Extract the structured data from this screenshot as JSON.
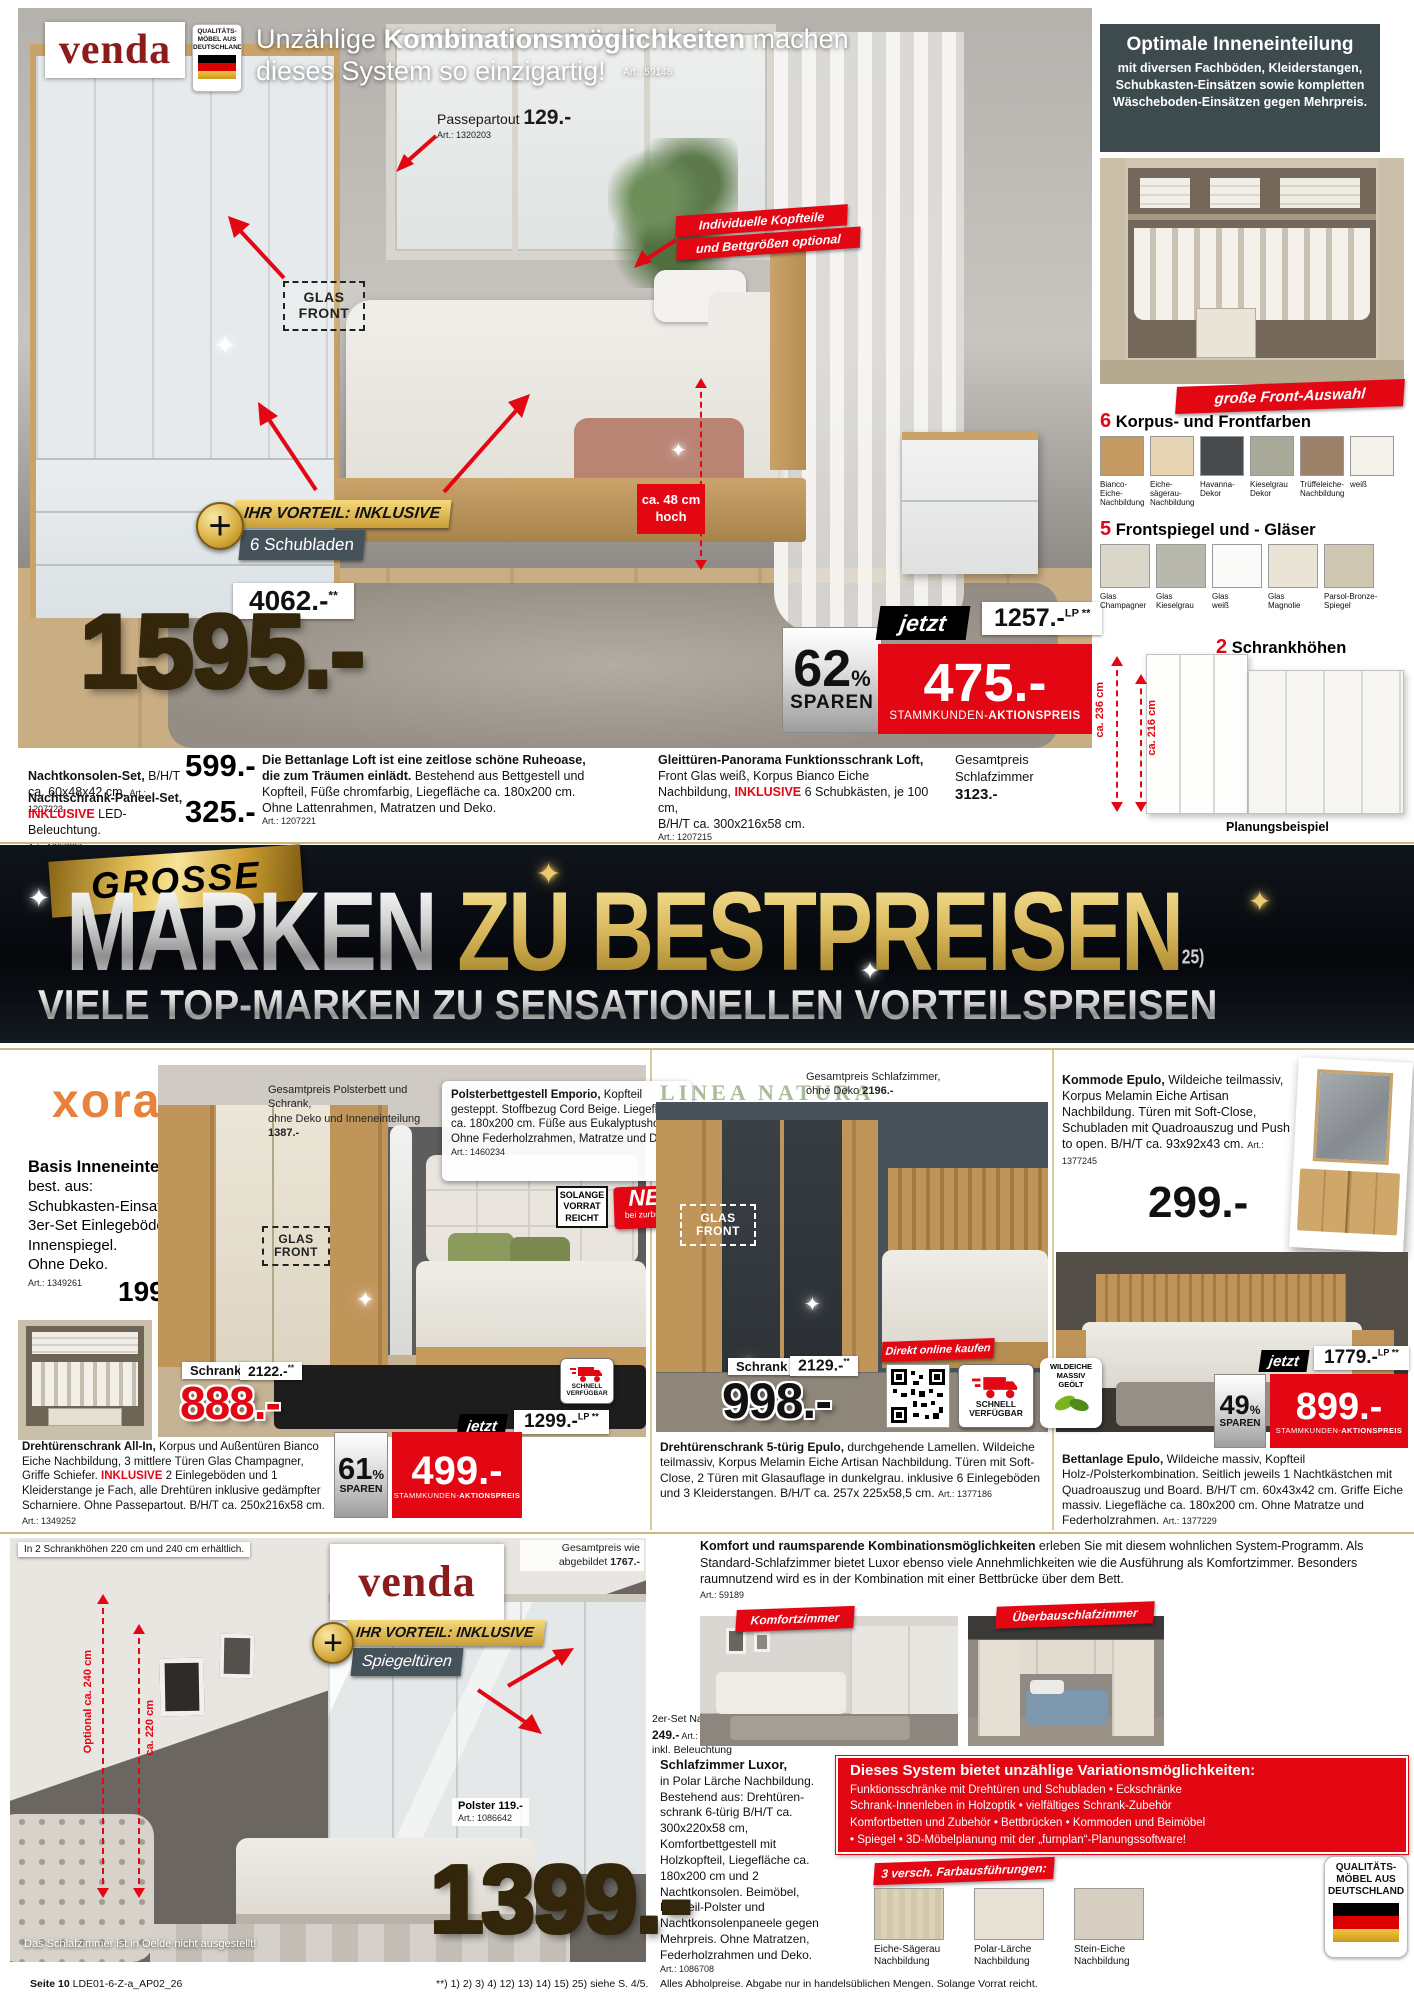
{
  "hero": {
    "logo": "venda",
    "quality": {
      "l1": "QUALITÄTS-",
      "l2": "MÖBEL AUS",
      "l3": "DEUTSCHLAND"
    },
    "headline": {
      "pre": "Unzählige ",
      "bold": "Kombinationsmöglichkeiten",
      "post": " machen",
      "line2": "dieses System so einzigartig!",
      "art": "Art.: 59148"
    },
    "passepartout": {
      "label": "Passepartout ",
      "price": "129.-",
      "art": "Art.: 1320203"
    },
    "headboard_badge": {
      "l1": "Individuelle Kopfteile",
      "l2": "und Bettgrößen optional"
    },
    "glas_front": "GLAS\nFRONT",
    "vorteil": {
      "plus": "+",
      "l1": "IHR VORTEIL: INKLUSIVE",
      "l2": "6 Schubladen"
    },
    "height_note": "ca. 48 cm\nhoch",
    "old_price": {
      "value": "4062.-",
      "sup": "**"
    },
    "big_price": "1595.-",
    "save": {
      "pct": "62",
      "sym": "%",
      "label": "SPAREN"
    },
    "jetzt": "jetzt",
    "action": {
      "price": "475.-",
      "label_normal": "STAMMKUNDEN-",
      "label_bold": "AKTIONSPREIS"
    },
    "lp": {
      "value": "1257.-",
      "sup": "LP **"
    }
  },
  "sidebar": {
    "info": {
      "title": "Optimale Inneneinteilung",
      "body": "mit diversen Fachböden, Kleiderstangen, Schubkasten-Einsätzen sowie kompletten Wäscheboden-Einsätzen gegen Mehrpreis."
    },
    "front_badge": "große Front-Auswahl",
    "colors": {
      "num": "6",
      "title": " Korpus- und Frontfarben",
      "items": [
        {
          "label": "Bianco-\nEiche-\nNachbildung",
          "hex": "#c49a62"
        },
        {
          "label": "Eiche-\nsägerau-\nNachbildung",
          "hex": "#e6d4b2"
        },
        {
          "label": "Havanna-\nDekor",
          "hex": "#474b4e"
        },
        {
          "label": "Kieselgrau\nDekor",
          "hex": "#a9a99a"
        },
        {
          "label": "Trüffeleiche-\nNachbildung",
          "hex": "#9a8168"
        },
        {
          "label": "weiß",
          "hex": "#f4f2eb"
        }
      ]
    },
    "glasses": {
      "num": "5",
      "title": " Frontspiegel und - Gläser",
      "items": [
        {
          "label": "Glas\nChampagner",
          "hex": "#dad6ca"
        },
        {
          "label": "Glas\nKieselgrau",
          "hex": "#b8b8ac"
        },
        {
          "label": "Glas\nweiß",
          "hex": "#fafaf8"
        },
        {
          "label": "Glas\nMagnolie",
          "hex": "#eae4d6"
        },
        {
          "label": "Parsol-Bronze-\nSpiegel",
          "hex": "#cfc7b2"
        }
      ]
    },
    "heights": {
      "num": "2",
      "title": " Schrankhöhen",
      "h1": "ca. 236 cm",
      "h2": "ca. 216 cm",
      "caption": "Planungsbeispiel"
    }
  },
  "strip": {
    "p1": {
      "bold": "Nachtkonsolen-Set,",
      "rest": " B/H/T\nca. 60x48x42 cm. ",
      "art": "Art.: 1207223",
      "price": "599.-"
    },
    "p2": {
      "bold": "Nachtschrank-Paneel-Set,",
      "inkl": "INKLUSIVE",
      "rest": " LED-Beleuchtung.",
      "art": "Art.: 1207227",
      "price": "325.-"
    },
    "p3": {
      "bold": "Die Bettanlage Loft ist eine zeitlose schöne Ruheoase, die zum Träumen einlädt.",
      "rest": " Bestehend aus Bettgestell und Kopfteil, Füße chromfarbig, Liegefläche ca. 180x200 cm. Ohne Lattenrahmen, Matratzen und Deko.",
      "art": "Art.: 1207221"
    },
    "p4": {
      "bold": "Gleittüren-Panorama Funktionsschrank Loft,",
      "rest": " Front Glas weiß, Korpus Bianco Eiche Nachbildung, ",
      "inkl": "INKLUSIVE",
      "rest2": " 6 Schubkästen, je 100 cm,\nB/H/T ca. 300x216x58 cm.",
      "art": "Art.: 1207215"
    },
    "total": {
      "l1": "Gesamtpreis",
      "l2": "Schlafzimmer",
      "price": "3123.-"
    }
  },
  "banner": {
    "grosse": "GROSSE",
    "marken": "MARKEN",
    "rest": " ZU BESTPREISEN",
    "sup": "25)",
    "subline": "VIELE TOP-MARKEN ZU SENSATIONELLEN VORTEILSPREISEN"
  },
  "xora": {
    "logo": "xora",
    "basis": {
      "title": "Basis Inneneinteilung",
      "body": "best. aus:\nSchubkasten-Einsatz,\n3er-Set Einlegeböden und\nInnenspiegel.\nOhne Deko.",
      "art": "Art.: 1349261",
      "price": "199.-"
    },
    "gesamt": {
      "normal": "Gesamtpreis Polsterbett und Schrank,\nohne Deko und Inneneinteilung ",
      "bold": "1387.-"
    },
    "emporio": {
      "bold": "Polsterbettgestell Emporio,",
      "rest": " Kopfteil gesteppt. Stoffbezug Cord Beige. Liegefläche ca. 180x200 cm. Füße aus Eukalyptusholz. Ohne Federholzrahmen, Matratze und Deko.",
      "art": "Art.: 1460234"
    },
    "solange": "SOLANGE\nVORRAT\nREICHT",
    "neu": {
      "big": "NEU",
      "small": "bei zurbrüggen"
    },
    "glas_front": "GLAS\nFRONT",
    "schrank_label": "Schrank",
    "old_price": {
      "value": "2122.-",
      "sup": "**"
    },
    "price": "888.-",
    "schnell": "SCHNELL\nVERFÜGBAR",
    "jetzt": "jetzt",
    "lp": {
      "value": "1299.-",
      "sup": "LP **"
    },
    "save": {
      "pct": "61",
      "sym": "%",
      "label": "SPAREN"
    },
    "action": {
      "price": "499.-",
      "label_normal": "STAMMKUNDEN-",
      "label_bold": "AKTIONSPREIS"
    },
    "desc": {
      "bold": "Drehtürenschrank All-In,",
      "rest": " Korpus und Außentüren Bianco Eiche Nachbildung, 3 mittlere Türen Glas Champagner, Griffe Schiefer. ",
      "inkl": "INKLUSIVE",
      "rest2": " 2 Einlegeböden und 1 Kleiderstange je Fach, alle Drehtüren inklusive gedämpfter Scharniere. Ohne Passepartout. B/H/T ca. 250x216x58 cm. ",
      "art": "Art.: 1349252"
    }
  },
  "linea": {
    "logo": "LINEA NATURA",
    "gesamt": {
      "normal": "Gesamtpreis Schlafzimmer,\nohne Deko ",
      "bold": "2196.-"
    },
    "glas_front": "GLAS\nFRONT",
    "schrank_label": "Schrank",
    "old_price": {
      "value": "2129.-",
      "sup": "**"
    },
    "price": "998.-",
    "direkt": "Direkt online kaufen",
    "schnell": "SCHNELL\nVERFÜGBAR",
    "wildeiche": "WILDEICHE\nMASSIV\nGEÖLT",
    "desc": {
      "bold": "Drehtürenschrank 5-türig Epulo,",
      "rest": " durchgehende Lamellen. Wildeiche teilmassiv, Korpus Melamin Eiche Artisan Nachbildung. Türen mit Soft-Close, 2 Türen mit Glasauflage in dunkelgrau. inklusive 6 Einlegeböden und 3 Kleiderstangen. B/H/T ca. 257x 225x58,5 cm. ",
      "art": "Art.: 1377186"
    }
  },
  "epulo": {
    "kommode": {
      "bold": "Kommode Epulo,",
      "rest": " Wildeiche teilmassiv, Korpus Melamin Eiche Artisan Nachbildung. Türen mit Soft-Close, Schubladen mit Quadroauszug und Push to open. B/H/T ca. 93x92x43 cm. ",
      "art": "Art.: 1377245",
      "price": "299.-"
    },
    "jetzt": "jetzt",
    "lp": {
      "value": "1779.-",
      "sup": "LP **"
    },
    "save": {
      "pct": "49",
      "sym": "%",
      "label": "SPAREN"
    },
    "action": {
      "price": "899.-",
      "label_normal": "STAMMKUNDEN-",
      "label_bold": "AKTIONSPREIS"
    },
    "bett": {
      "bold": "Bettanlage Epulo,",
      "rest": " Wildeiche massiv, Kopfteil Holz-/Polsterkombination. Seitlich jeweils 1 Nachtkästchen mit Quadroauszug und Board. B/H/T cm. 60x43x42 cm. Griffe Eiche massiv. Liegefläche ca. 180x200 cm. Ohne Matratze und Federholzrahmen. ",
      "art": "Art.: 1377229"
    }
  },
  "luxor": {
    "note": "In 2 Schrankhöhen 220 cm und 240 cm erhältlich.",
    "logo": "venda",
    "vorteil": {
      "plus": "+",
      "l1": "IHR VORTEIL: INKLUSIVE",
      "l2": "Spiegeltüren"
    },
    "m240": "Optional ca. 240 cm",
    "m220": "ca. 220 cm",
    "gesamt": {
      "l1": "Gesamtpreis wie",
      "l2": "abgebildet ",
      "l2b": "1767.-"
    },
    "polster": {
      "bold": "Polster 119.-",
      "art": "Art.: 1086642"
    },
    "paneel": {
      "l1": "2er-Set Nachtkonsolenpaneel",
      "price": "249.-",
      "art": " Art.: 1086644",
      "l3": "inkl. Beleuchtung"
    },
    "oelde": "Das Schlafzimmer ist in Oelde nicht ausgestellt!",
    "big_price": "1399.-",
    "intro": {
      "bold": "Komfort und raumsparende Kombinationsmöglichkeiten",
      "rest": " erleben Sie mit diesem wohnlichen System-Programm. Als Standard-Schlafzimmer bietet Luxor ebenso viele Annehmlichkeiten wie die Ausführung als Komfortzimmer. Besonders raumnutzend wird es in der Kombination mit einer Bettbrücke über dem Bett.",
      "art": "Art.: 59189"
    },
    "badge1": "Komfortzimmer",
    "badge2": "Überbauschlafzimmer",
    "desc": {
      "bold": "Schlafzimmer Luxor,",
      "rest": "in Polar Lärche Nachbildung. Bestehend aus: Drehtüren­schrank 6-türig B/H/T ca. 300x220x58 cm, Komfortbettgestell mit Holzkopfteil, Liegefläche ca. 180x200 cm und 2 Nachtkonsolen. Beimöbel, Kopfteil-Polster und Nachtkonsolenpaneele gegen Mehrpreis. Ohne Matratzen, Federholzrahmen und Deko.",
      "art": "Art.: 1086708"
    },
    "variations": {
      "title": "Dieses System bietet unzählige Variationsmöglichkeiten:",
      "body": "Funktionsschränke mit Drehtüren und Schubladen • Eckschränke\nSchrank-Innenleben in Holzoptik • vielfältiges Schrank-Zubehör\nKomfortbetten und Zubehör • Bettbrücken • Kommoden und Beimöbel\n• Spiegel • 3D-Möbelplanung mit der „furnplan“-Planungssoftware!"
    },
    "farben": {
      "title": "3 versch. Farbausführungen:",
      "items": [
        {
          "label": "Eiche-Sägerau\nNachbildung",
          "hex": "#ddd2b6"
        },
        {
          "label": "Polar-Lärche\nNachbildung",
          "hex": "#e7e0d4"
        },
        {
          "label": "Stein-Eiche\nNachbildung",
          "hex": "#d6cec0"
        }
      ]
    },
    "quality": {
      "l1": "QUALITÄTS-",
      "l2": "MÖBEL AUS",
      "l3": "DEUTSCHLAND"
    }
  },
  "footer": {
    "page": "Seite 10",
    "code": " LDE01-6-Z-a_AP02_26",
    "refs": "**) 1) 2) 3) 4) 12) 13) 14) 15) 25) siehe S. 4/5.",
    "legal": "Alles Abholpreise. Abgabe nur in handelsüblichen Mengen. Solange Vorrat reicht."
  },
  "colors": {
    "accent_red": "#e30613",
    "venda_red": "#8c1c1c",
    "gold": "#d9b85c",
    "dark_info": "#3d4a4e",
    "xora_orange": "#e8813b",
    "linea_green": "#a9bb97"
  }
}
